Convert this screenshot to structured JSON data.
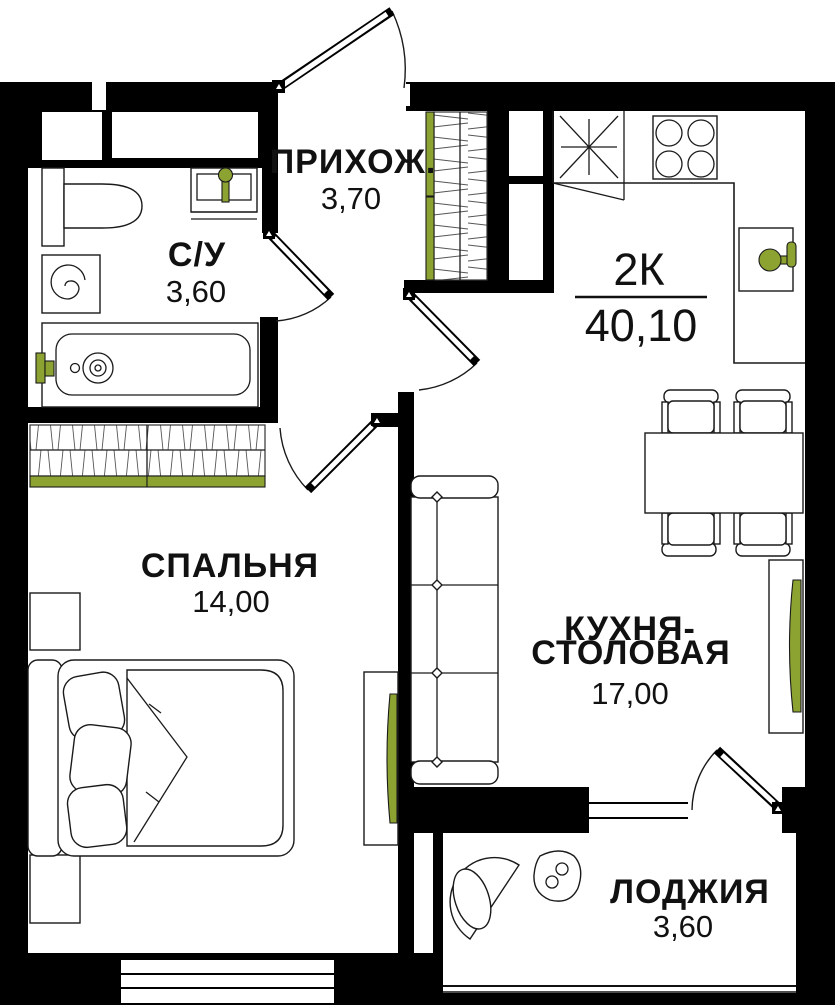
{
  "plan": {
    "apartment": {
      "type_label": "2К",
      "area_value": "40,10"
    },
    "rooms": [
      {
        "id": "hallway",
        "label": "ПРИХОЖ.",
        "area": "3,70"
      },
      {
        "id": "bathroom",
        "label": "С/У",
        "area": "3,60"
      },
      {
        "id": "bedroom",
        "label": "СПАЛЬНЯ",
        "area": "14,00"
      },
      {
        "id": "kitchen-dining",
        "label_line1": "КУХНЯ-",
        "label_line2": "СТОЛОВАЯ",
        "area": "17,00"
      },
      {
        "id": "loggia",
        "label": "ЛОДЖИЯ",
        "area": "3,60"
      }
    ]
  },
  "colors": {
    "wall": "#000000",
    "line": "#1A1A1A",
    "accent_green": "#8CA331",
    "text": "#111111",
    "background": "#FFFFFF"
  }
}
